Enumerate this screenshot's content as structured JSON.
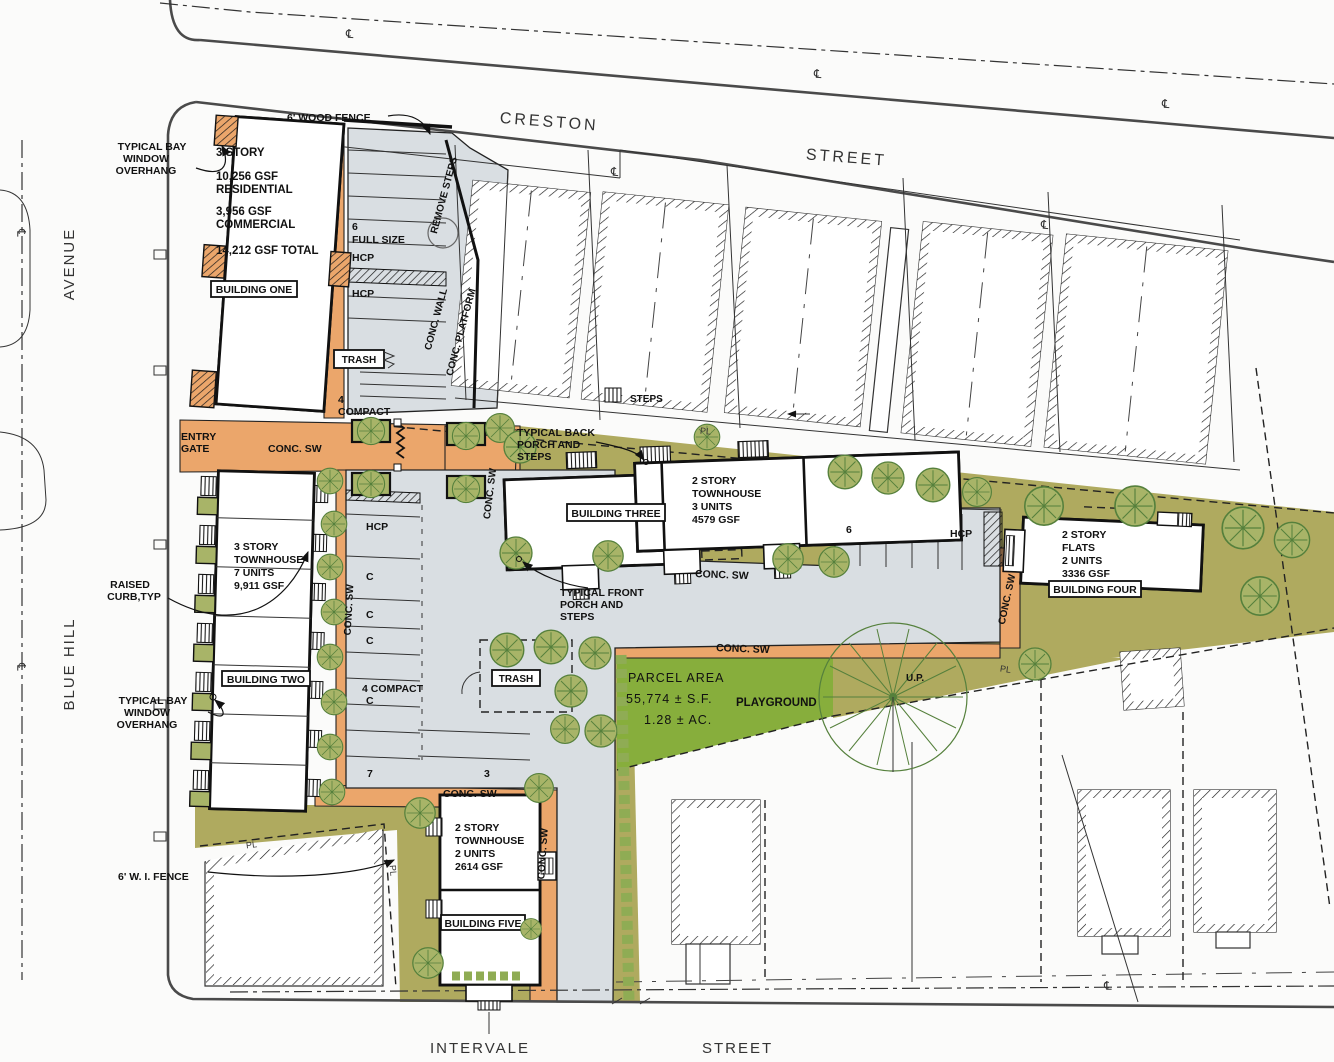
{
  "colors": {
    "sidewalk": "#EBA66B",
    "pavement": "#D9DEE2",
    "landscape": "#AFAA5F",
    "playground_green": "#87AE3C",
    "tree_line": "#55803C",
    "linework": "#111111"
  },
  "streets": {
    "creston_name": "CRESTON",
    "creston_type": "STREET",
    "blue_hill_name": "BLUE HILL",
    "blue_hill_type": "AVENUE",
    "intervale_name": "INTERVALE",
    "intervale_type": "STREET"
  },
  "buildings": {
    "one": {
      "label": "BUILDING ONE",
      "l1": "3 STORY",
      "l2": "10,256 GSF",
      "l3": "RESIDENTIAL",
      "l4": "3,956 GSF",
      "l5": "COMMERCIAL",
      "l6": "14,212 GSF TOTAL"
    },
    "two": {
      "label": "BUILDING TWO",
      "l1": "3 STORY",
      "l2": "TOWNHOUSE",
      "l3": "7 UNITS",
      "l4": "9,911 GSF"
    },
    "three": {
      "label": "BUILDING THREE",
      "l1": "2 STORY",
      "l2": "TOWNHOUSE",
      "l3": "3 UNITS",
      "l4": "4579 GSF"
    },
    "four": {
      "label": "BUILDING FOUR",
      "l1": "2 STORY",
      "l2": "FLATS",
      "l3": "2 UNITS",
      "l4": "3336 GSF"
    },
    "five": {
      "label": "BUILDING FIVE",
      "l1": "2 STORY",
      "l2": "TOWNHOUSE",
      "l3": "2 UNITS",
      "l4": "2614 GSF"
    }
  },
  "parking": {
    "north_count": "6",
    "full_size": "FULL SIZE",
    "hcp": "HCP",
    "trash": "TRASH",
    "compact_count": "4",
    "compact": "COMPACT",
    "c": "C",
    "four_compact": "4 COMPACT",
    "row7": "7",
    "row3": "3",
    "east_count": "6"
  },
  "site": {
    "parcel1": "PARCEL AREA",
    "parcel2": "55,774 ± S.F.",
    "parcel3": "1.28 ± AC.",
    "playground": "PLAYGROUND"
  },
  "ann": {
    "bay1": "TYPICAL BAY",
    "bay2": "WINDOW",
    "bay3": "OVERHANG",
    "wood_fence": "6' WOOD FENCE",
    "wi_fence": "6' W. I. FENCE",
    "entry1": "ENTRY",
    "entry2": "GATE",
    "raised1": "RAISED",
    "raised2": "CURB,TYP",
    "back1": "TYPICAL BACK",
    "back2": "PORCH AND",
    "back3": "STEPS",
    "front1": "TYPICAL FRONT",
    "front2": "PORCH AND",
    "front3": "STEPS",
    "remove_steps": "REMOVE STEPS",
    "conc_wall": "CONC. WALL",
    "conc_platform": "CONC. PLATFORM",
    "conc_sw": "CONC. SW",
    "steps": "STEPS",
    "up": "U.P."
  },
  "sym": {
    "cl": "℄",
    "pl": "PL"
  }
}
